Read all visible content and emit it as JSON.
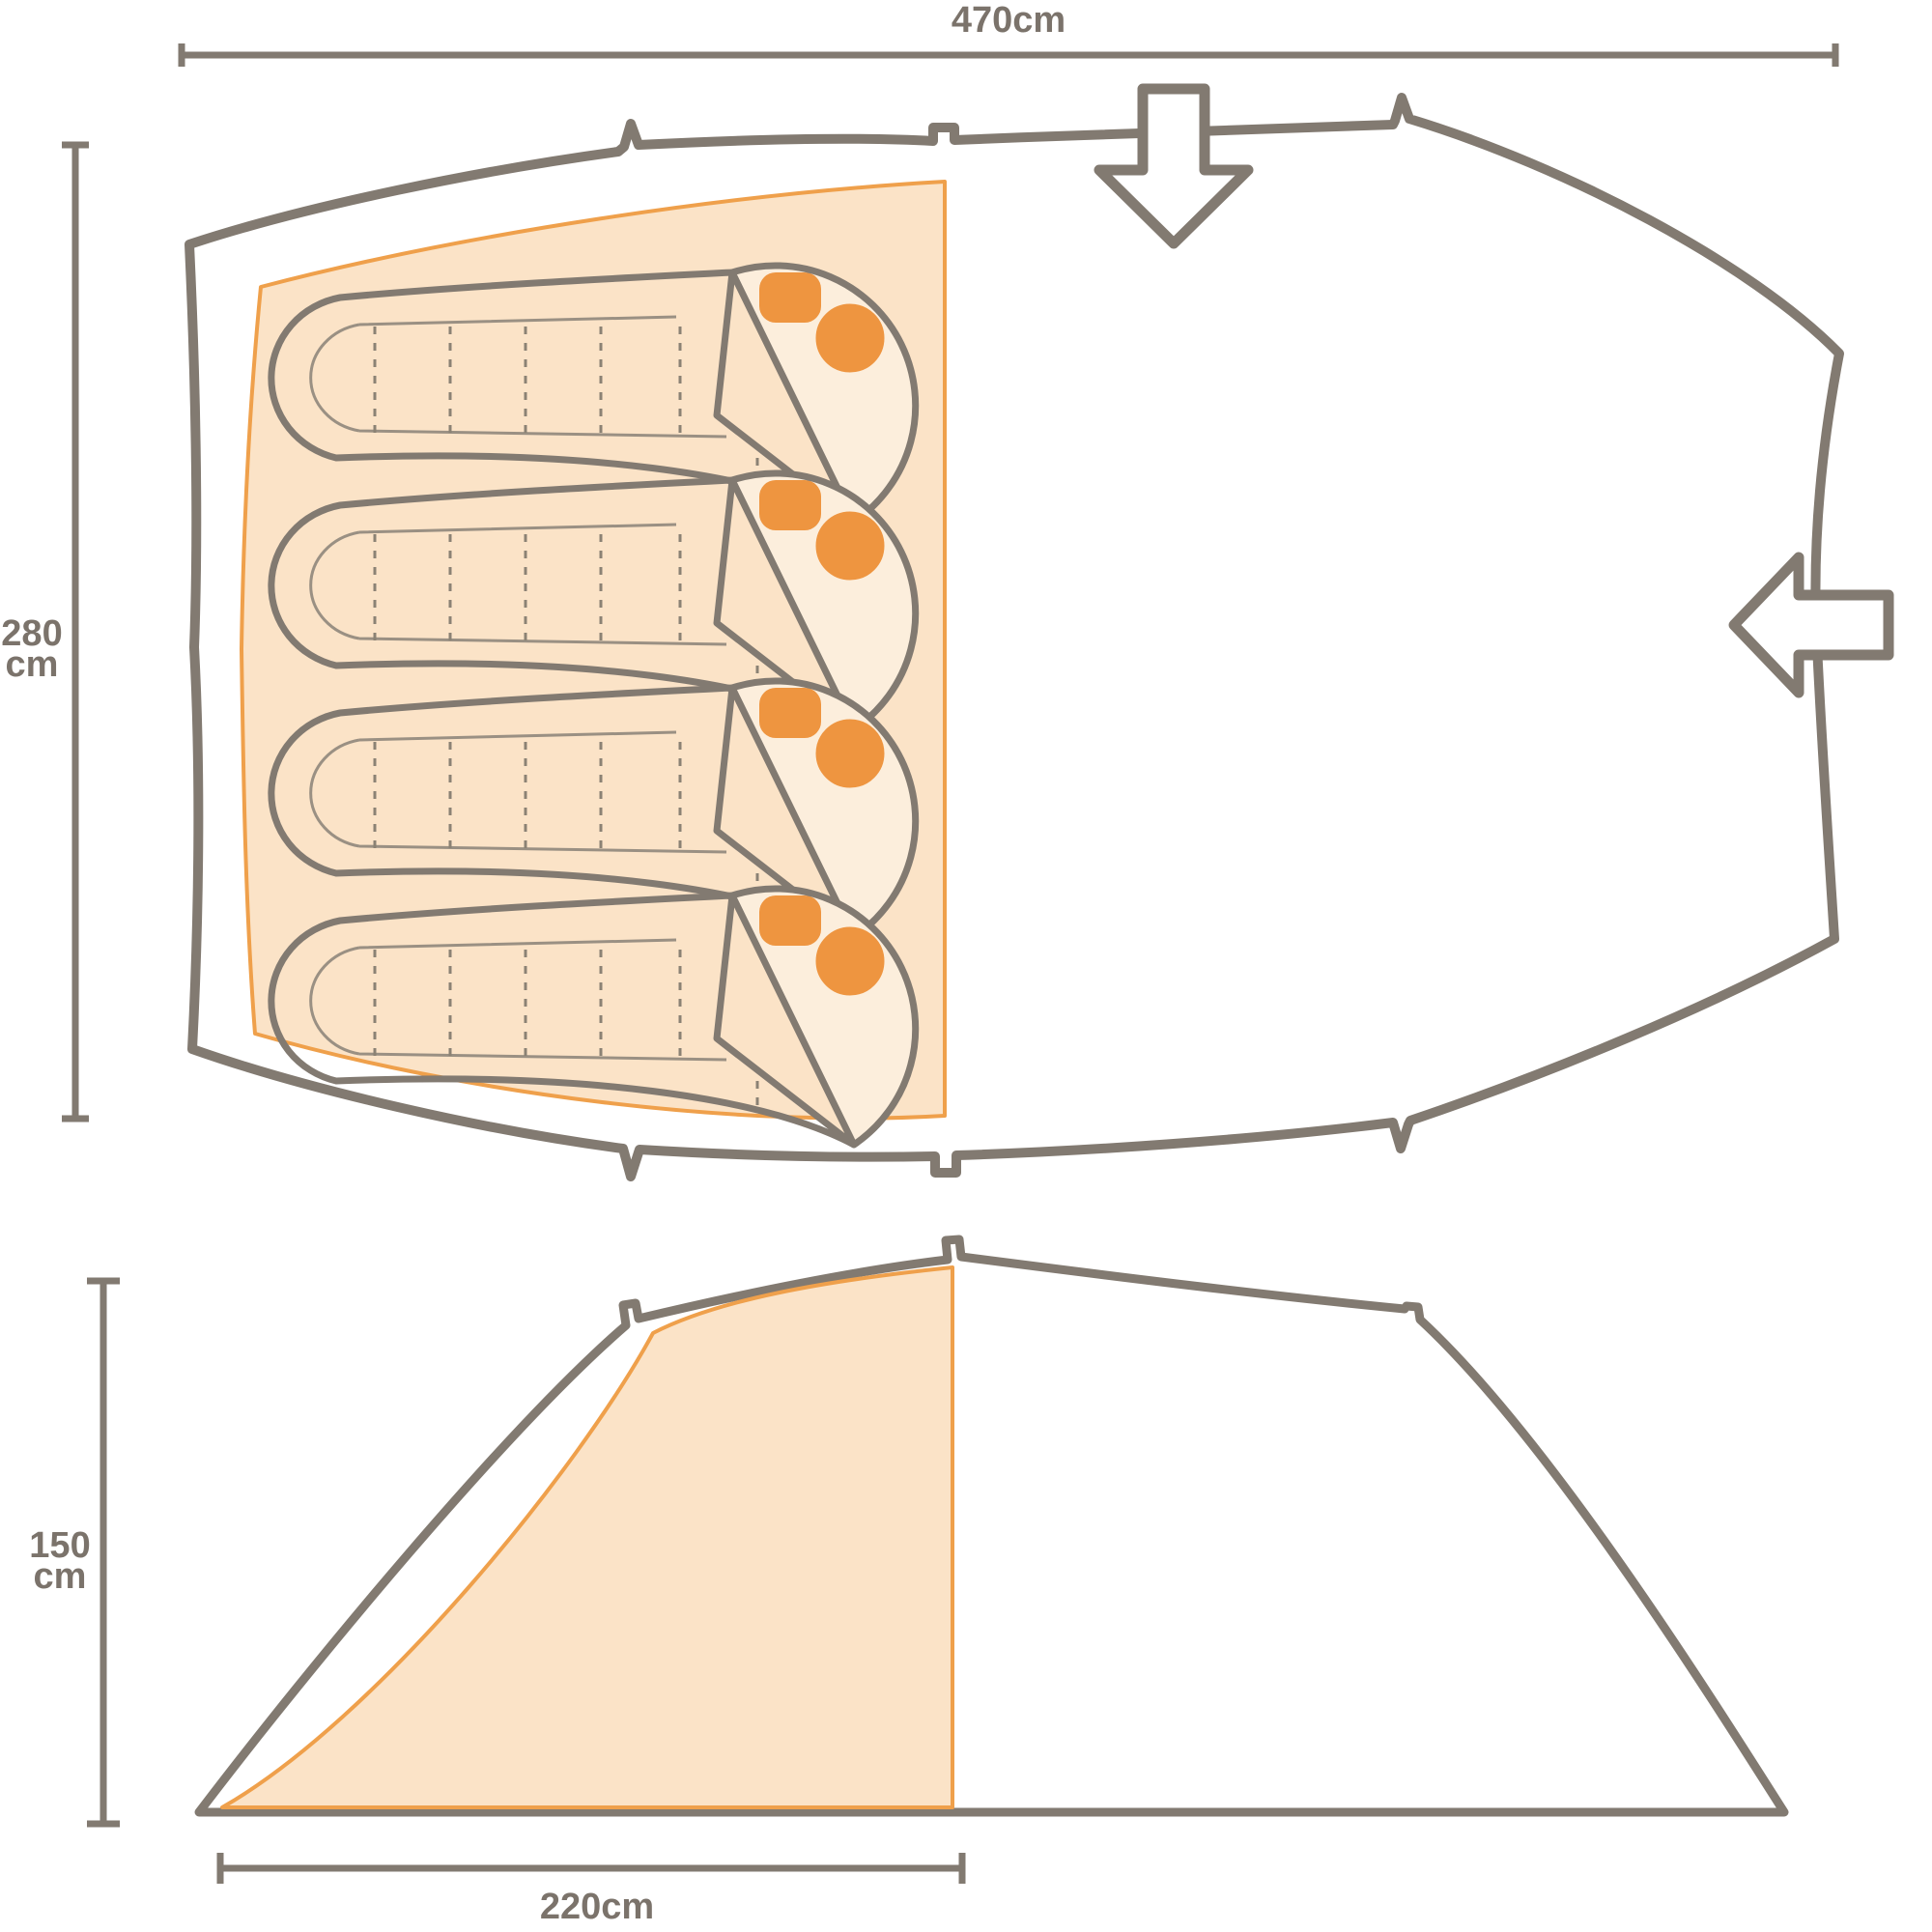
{
  "diagram": {
    "type": "tent-dimensions-diagram",
    "views": [
      "floor-plan-top-view",
      "side-elevation-view"
    ],
    "berth_count": 4,
    "entrance_arrows": [
      "front-entrance-down-arrow",
      "side-entrance-left-arrow"
    ]
  },
  "top_view": {
    "width_label": "470cm",
    "depth_label_line1": "280",
    "depth_label_line2": "cm"
  },
  "side_view": {
    "height_label_line1": "150",
    "height_label_line2": "cm",
    "inner_width_label": "220cm"
  },
  "dimensions": {
    "total_width_cm": 470,
    "total_depth_cm": 280,
    "height_cm": 150,
    "sleeping_area_depth_cm": 220
  },
  "colors": {
    "outline_gray": "#827a71",
    "dimension_text": "#7b736b",
    "sleeping_area_fill": "#fbe3c7",
    "sleeping_area_stroke": "#efa04b",
    "accent_orange": "#ee9540",
    "opening_fill": "#fceedc"
  }
}
